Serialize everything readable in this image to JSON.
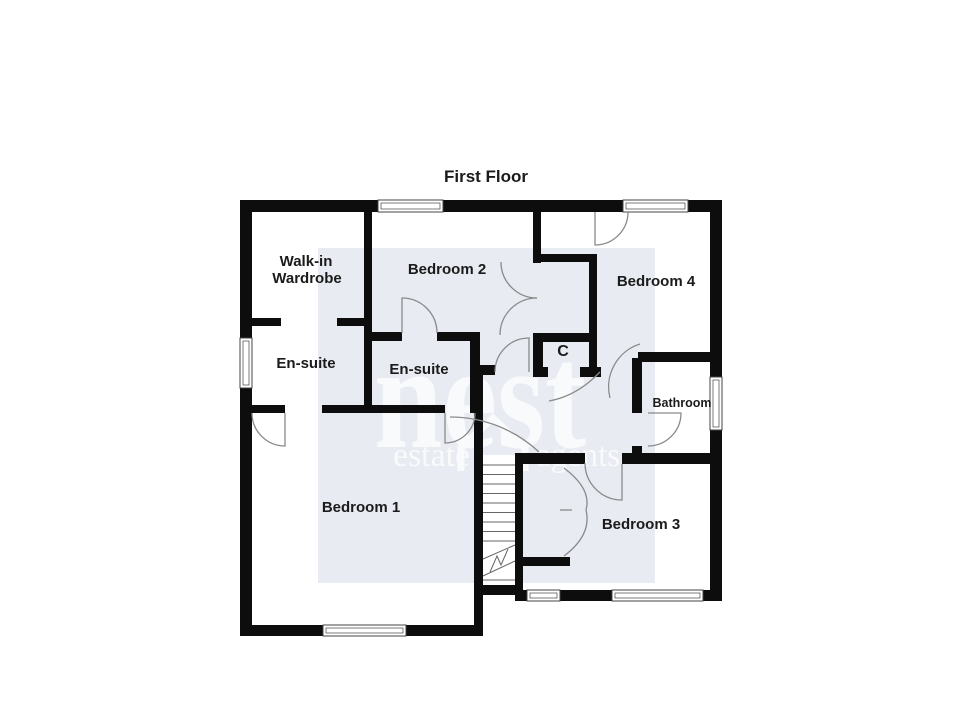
{
  "title": "First Floor",
  "rooms": {
    "walk_in_wardrobe": {
      "line1": "Walk-in",
      "line2": "Wardrobe"
    },
    "bedroom2": "Bedroom 2",
    "bedroom4": "Bedroom 4",
    "ensuite_left": "En-suite",
    "ensuite_middle": "En-suite",
    "cupboard": "C",
    "bathroom": "Bathroom",
    "bedroom1": "Bedroom 1",
    "bedroom3": "Bedroom 3"
  },
  "watermark": {
    "brand": "nest",
    "tagline_left": "estate",
    "tagline_right": "agents"
  },
  "colors": {
    "background": "#ffffff",
    "wall": "#0d0d0d",
    "tint_panel": "#e8ebf2",
    "label_text": "#1b1b1b",
    "door_arc": "#8a8a8a",
    "window_frame": "#444444",
    "stair_line": "#666666",
    "watermark": "#ffffff"
  }
}
